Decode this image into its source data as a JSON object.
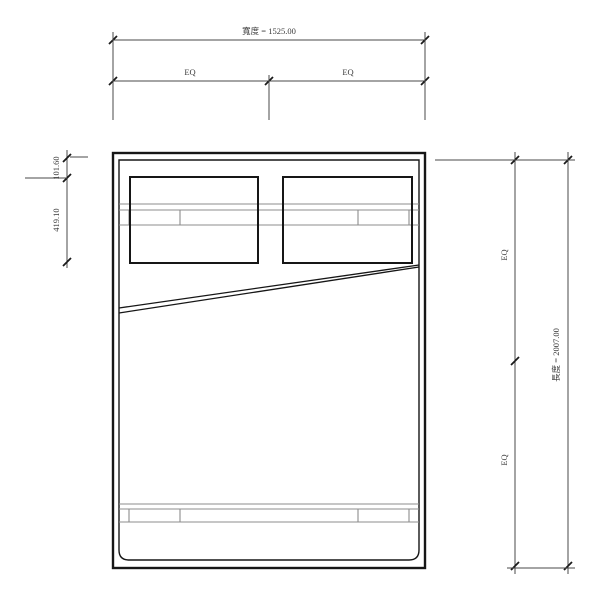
{
  "page": {
    "background": "#ffffff",
    "description": "bed-plan-cad-drawing"
  },
  "drawing": {
    "type": "bed-plan",
    "colors": {
      "outline": "#161616",
      "rail": "#8c8c8c",
      "dimension_line": "#4a4a4a",
      "dimension_text": "#3a3a3a",
      "background": "#ffffff"
    }
  },
  "dimensions": {
    "width": {
      "label": "寬度 = 1525.00"
    },
    "width_eq": {
      "left": "EQ",
      "right": "EQ"
    },
    "length": {
      "label": "長度 = 2007.00"
    },
    "length_eq": {
      "upper": "EQ",
      "lower": "EQ"
    },
    "pillow_top_offset": {
      "label": "101.60"
    },
    "pillow_depth": {
      "label": "419.10"
    }
  }
}
